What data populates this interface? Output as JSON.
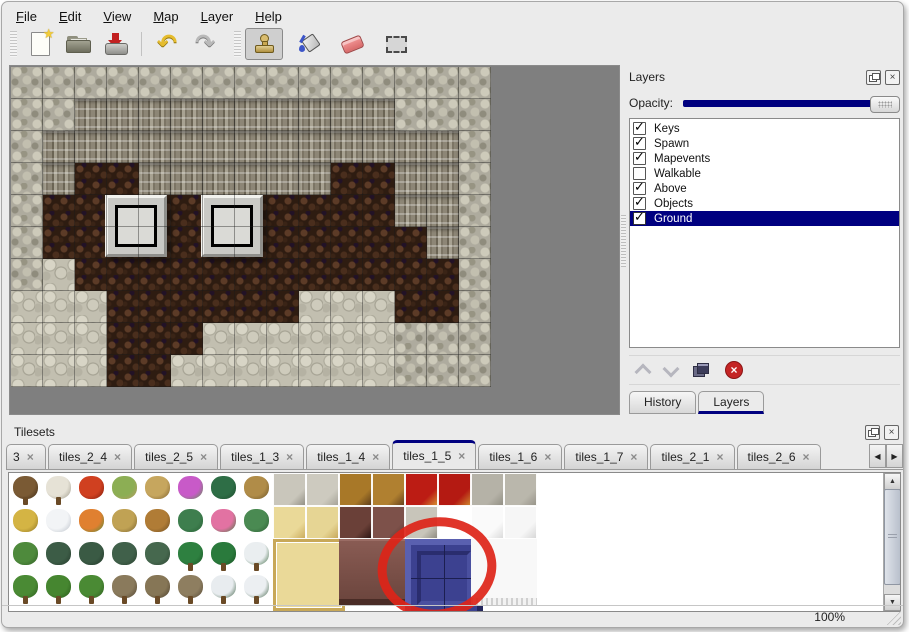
{
  "colors": {
    "accent_navy": "#000080",
    "map_background": "#7f7f7f",
    "annotation_red": "#dd2418",
    "blue_tile": "#3c4190",
    "window_bg": "#ebebeb"
  },
  "icons": {
    "close": "×",
    "check": "✓",
    "star": "★",
    "undo": "↶",
    "redo": "↷",
    "left": "◀",
    "right": "▶",
    "up": "▲",
    "down": "▼"
  },
  "menu": {
    "items": [
      {
        "label": "File"
      },
      {
        "label": "Edit"
      },
      {
        "label": "View"
      },
      {
        "label": "Map"
      },
      {
        "label": "Layer"
      },
      {
        "label": "Help"
      }
    ]
  },
  "toolbar": {
    "buttons": [
      {
        "name": "new"
      },
      {
        "name": "open"
      },
      {
        "name": "save"
      },
      {
        "name": "undo"
      },
      {
        "name": "redo"
      },
      {
        "name": "stamp",
        "active": true
      },
      {
        "name": "fill"
      },
      {
        "name": "eraser"
      },
      {
        "name": "select"
      }
    ]
  },
  "map": {
    "tile_size": 32,
    "cols": 15,
    "rows": 10,
    "legend": {
      "S": "scale-stone-wall",
      "C": "cliff-face",
      "B": "brown-cave-floor",
      "R": "light-rubble"
    },
    "grid": [
      "SSSSSSSSSSSSSSS",
      "SSCCCCCCCCCCSSS",
      "SCCCCCCCCCCCCCS",
      "SCBBCCCCCCBBCCS",
      "SBBBBBBBBBBBCCS",
      "SBBBBBBBBBBBBCS",
      "SRBBBBBBBBBBBBS",
      "RRRBBBBBBRRRBBS",
      "RRRBBBRRRRRRSSS",
      "RRRBBRRRRRRRSSS"
    ],
    "platforms": [
      {
        "x": 94,
        "y": 128
      },
      {
        "x": 190,
        "y": 128
      }
    ]
  },
  "layers_panel": {
    "title": "Layers",
    "opacity_label": "Opacity:",
    "opacity_value": 100,
    "layers": [
      {
        "name": "Keys",
        "checked": true,
        "selected": false
      },
      {
        "name": "Spawn",
        "checked": true,
        "selected": false
      },
      {
        "name": "Mapevents",
        "checked": true,
        "selected": false
      },
      {
        "name": "Walkable",
        "checked": false,
        "selected": false
      },
      {
        "name": "Above",
        "checked": true,
        "selected": false
      },
      {
        "name": "Objects",
        "checked": true,
        "selected": false
      },
      {
        "name": "Ground",
        "checked": true,
        "selected": true
      }
    ],
    "tabs": [
      {
        "label": "History",
        "active": false
      },
      {
        "label": "Layers",
        "active": true
      }
    ]
  },
  "tilesets_panel": {
    "title": "Tilesets",
    "tabs": [
      {
        "label": "3",
        "truncated": true
      },
      {
        "label": "tiles_2_4"
      },
      {
        "label": "tiles_2_5"
      },
      {
        "label": "tiles_1_3"
      },
      {
        "label": "tiles_1_4"
      },
      {
        "label": "tiles_1_5",
        "active": true
      },
      {
        "label": "tiles_1_6"
      },
      {
        "label": "tiles_1_7"
      },
      {
        "label": "tiles_2_1"
      },
      {
        "label": "tiles_2_6"
      }
    ],
    "grid": {
      "cell": 33,
      "rows": [
        [
          {
            "n": "dead-tree",
            "k": "blob",
            "c": [
              "#7a5a34",
              "#3d2a16"
            ],
            "s": true
          },
          {
            "n": "birch-tree",
            "k": "blob",
            "c": [
              "#e6e2d6",
              "#9a9688"
            ],
            "s": true
          },
          {
            "n": "red-flower",
            "k": "blob",
            "c": [
              "#d04020",
              "#7a1808"
            ]
          },
          {
            "n": "stump",
            "k": "blob",
            "c": [
              "#8cae54",
              "#b99a62"
            ]
          },
          {
            "n": "trunk",
            "k": "blob",
            "c": [
              "#c6a65e",
              "#7a5c2a"
            ]
          },
          {
            "n": "purple-flowers",
            "k": "blob",
            "c": [
              "#c85ac8",
              "#58984a"
            ]
          },
          {
            "n": "fern",
            "k": "blob",
            "c": [
              "#2e6e46",
              "#1c4a2c"
            ]
          },
          {
            "n": "dead-shrub",
            "k": "blob",
            "c": [
              "#b08c48",
              "#6a5428"
            ]
          },
          {
            "n": "stone-floor-corner",
            "k": "fill",
            "c": [
              "#c9c6bb",
              "#8e8b80"
            ]
          },
          {
            "n": "stone-floor",
            "k": "fill",
            "c": [
              "#cdcabf",
              "#a29f94"
            ]
          },
          {
            "n": "wood-table-top",
            "k": "fill",
            "c": [
              "#a87828",
              "#583818"
            ]
          },
          {
            "n": "wood-table-top",
            "k": "fill",
            "c": [
              "#b08030",
              "#603c1a"
            ]
          },
          {
            "n": "red-carpet",
            "k": "fill",
            "c": [
              "#bc1c14",
              "#d89a34"
            ]
          },
          {
            "n": "red-carpet",
            "k": "fill",
            "c": [
              "#b41a12",
              "#d09030"
            ]
          },
          {
            "n": "gray-stone",
            "k": "fill",
            "c": [
              "#b5b2a7",
              "#908d82"
            ]
          },
          {
            "n": "gray-stone",
            "k": "fill",
            "c": [
              "#bab7ac",
              "#959287"
            ]
          }
        ],
        [
          {
            "n": "hay-mound",
            "k": "blob",
            "c": [
              "#d4b444",
              "#8a7020"
            ]
          },
          {
            "n": "snow-mound",
            "k": "blob",
            "c": [
              "#f2f4f6",
              "#b8bec6"
            ]
          },
          {
            "n": "orange-flowers",
            "k": "blob",
            "c": [
              "#e08030",
              "#4a8a3a"
            ]
          },
          {
            "n": "dry-grass",
            "k": "blob",
            "c": [
              "#c0a254",
              "#77602c"
            ]
          },
          {
            "n": "leaves",
            "k": "blob",
            "c": [
              "#b07c36",
              "#6a4a1e"
            ]
          },
          {
            "n": "lily-pads",
            "k": "blob",
            "c": [
              "#3e7e4e",
              "#276034"
            ]
          },
          {
            "n": "pink-flowers",
            "k": "blob",
            "c": [
              "#e272a2",
              "#3f7a40"
            ]
          },
          {
            "n": "lily-pad",
            "k": "blob",
            "c": [
              "#4a8a52",
              "#2c5c34"
            ]
          },
          {
            "n": "mat-corner",
            "k": "fill",
            "c": [
              "#ead998",
              "#c8a858"
            ]
          },
          {
            "n": "mat",
            "k": "fill",
            "c": [
              "#e6d594",
              "#c4a454"
            ]
          },
          {
            "n": "dark-chair",
            "k": "fill",
            "c": [
              "#6a4038",
              "#281210"
            ]
          },
          {
            "n": "brown-block",
            "k": "fill",
            "c": [
              "#7d514a",
              "#56322c"
            ]
          },
          {
            "n": "stone-pillar",
            "k": "fill",
            "c": [
              "#c8c5ba",
              "#8a877c"
            ]
          },
          {
            "n": "stone-pillar",
            "k": "fill",
            "c": [
              "#c2bfb4",
              "#84817б"
            ]
          },
          {
            "n": "white-fur",
            "k": "fill",
            "c": [
              "#fafafa",
              "#d8d8d8"
            ]
          },
          {
            "n": "white-fur",
            "k": "fill",
            "c": [
              "#f6f6f6",
              "#d4d4d4"
            ]
          }
        ],
        [
          {
            "n": "sprouts",
            "k": "blob",
            "c": [
              "#4e8a3c",
              "#2f5c24"
            ]
          },
          {
            "n": "dark-bush",
            "k": "blob",
            "c": [
              "#3c5c46",
              "#24382a"
            ]
          },
          {
            "n": "dark-bush",
            "k": "blob",
            "c": [
              "#3a5a44",
              "#223628"
            ]
          },
          {
            "n": "dark-bush",
            "k": "blob",
            "c": [
              "#40604a",
              "#28402e"
            ]
          },
          {
            "n": "bush",
            "k": "blob",
            "c": [
              "#46684e",
              "#2c4432"
            ]
          },
          {
            "n": "palm-tree",
            "k": "blob",
            "c": [
              "#2e8040",
              "#1a5426"
            ],
            "s": true
          },
          {
            "n": "palm-tree",
            "k": "blob",
            "c": [
              "#2a7a3c",
              "#185022"
            ],
            "s": true
          },
          {
            "n": "snow-tree",
            "k": "blob",
            "c": [
              "#eaeef0",
              "#39663f"
            ],
            "s": true
          },
          {
            "n": "mat-large-part",
            "k": "part",
            "c": [
              "#ead998"
            ]
          },
          {
            "n": "mat-large-part",
            "k": "part",
            "c": [
              "#ead998"
            ]
          },
          {
            "n": "table-large-part",
            "k": "part",
            "c": [
              "#7d514a"
            ]
          },
          {
            "n": "table-large-part",
            "k": "part",
            "c": [
              "#7d514a"
            ]
          },
          {
            "n": "blue-tile-part",
            "k": "part",
            "c": [
              "#3c4190"
            ]
          },
          {
            "n": "blue-tile-part",
            "k": "part",
            "c": [
              "#3c4190"
            ]
          },
          {
            "n": "white-fluff-part",
            "k": "part",
            "c": [
              "#f6f6f6"
            ]
          },
          {
            "n": "white-fluff-part",
            "k": "part",
            "c": [
              "#f6f6f6"
            ]
          }
        ],
        [
          {
            "n": "conifer",
            "k": "blob",
            "c": [
              "#4a8a34",
              "#2c5c1e"
            ],
            "s": true
          },
          {
            "n": "conifer",
            "k": "blob",
            "c": [
              "#468630",
              "#28581a"
            ],
            "s": true
          },
          {
            "n": "conifer",
            "k": "blob",
            "c": [
              "#4a8a34",
              "#2c5c1e"
            ],
            "s": true
          },
          {
            "n": "dead-tree",
            "k": "blob",
            "c": [
              "#8a7a5c",
              "#4e4230"
            ],
            "s": true
          },
          {
            "n": "dead-tree",
            "k": "blob",
            "c": [
              "#867656",
              "#4a3e2c"
            ],
            "s": true
          },
          {
            "n": "dead-tree",
            "k": "blob",
            "c": [
              "#8e7e60",
              "#524634"
            ],
            "s": true
          },
          {
            "n": "snow-pine",
            "k": "blob",
            "c": [
              "#e8ecef",
              "#3a5c40"
            ],
            "s": true
          },
          {
            "n": "snow-pine",
            "k": "blob",
            "c": [
              "#eceff2",
              "#3e6044"
            ],
            "s": true
          },
          {
            "n": "mat-large-part",
            "k": "part",
            "c": [
              "#ead998"
            ]
          },
          {
            "n": "mat-large-part",
            "k": "part",
            "c": [
              "#ead998"
            ]
          },
          {
            "n": "table-large-part",
            "k": "part",
            "c": [
              "#7d514a"
            ]
          },
          {
            "n": "table-large-part",
            "k": "part",
            "c": [
              "#7d514a"
            ]
          },
          {
            "n": "blue-tile-part",
            "k": "part",
            "c": [
              "#3c4190"
            ]
          },
          {
            "n": "blue-tile-part",
            "k": "part",
            "c": [
              "#3c4190"
            ]
          },
          {
            "n": "white-fluff-part",
            "k": "part",
            "c": [
              "#f6f6f6"
            ]
          },
          {
            "n": "white-fluff-part",
            "k": "part",
            "c": [
              "#f6f6f6"
            ]
          }
        ]
      ],
      "blocks": [
        {
          "name": "large-mat-tile",
          "cls": "blk-mat",
          "col": 8,
          "row": 2
        },
        {
          "name": "large-table-tile",
          "cls": "blk-table",
          "col": 10,
          "row": 2
        },
        {
          "name": "blue-selected-tile",
          "cls": "blk-blue",
          "col": 12,
          "row": 2
        },
        {
          "name": "white-fluff-tile",
          "cls": "blk-fluff",
          "col": 14,
          "row": 2
        }
      ]
    },
    "annotation": {
      "shape": "ellipse",
      "cx": 428,
      "cy": 95,
      "rx": 55,
      "ry": 46,
      "stroke": "#dd2418",
      "stroke_width": 9,
      "rotation": -8
    }
  },
  "status_bar": {
    "zoom": "100%"
  }
}
